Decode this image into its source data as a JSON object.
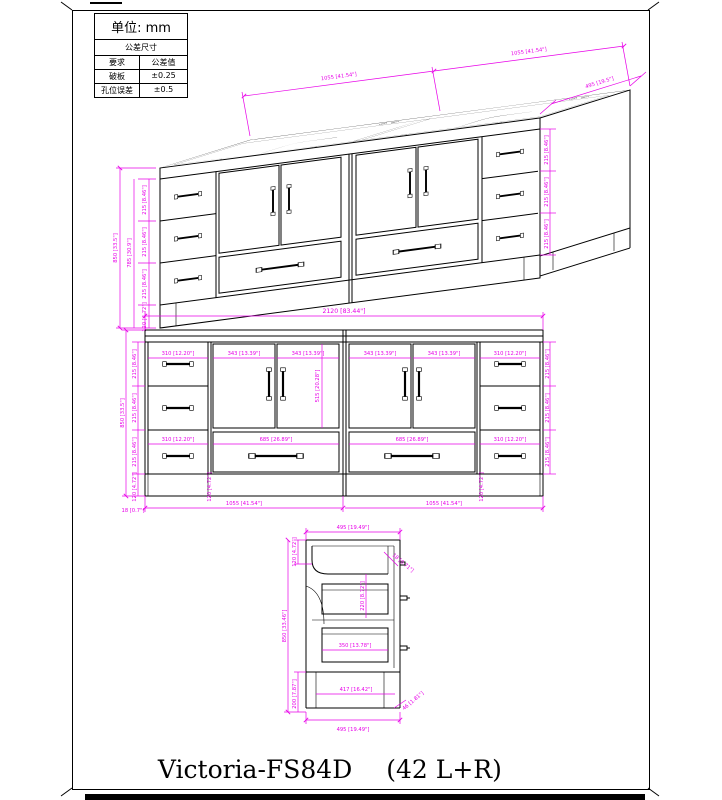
{
  "title": {
    "model": "Victoria-FS84D",
    "config": "(42 L+R)"
  },
  "tolerance_table": {
    "unit_label": "单位: mm",
    "header": "公差尺寸",
    "col_requirement": "要求",
    "col_value": "公差值",
    "rows": [
      {
        "name": "破板",
        "value": "±0.25"
      },
      {
        "name": "孔位误差",
        "value": "±0.5"
      }
    ]
  },
  "colors": {
    "dimension": "#e800e8",
    "line": "#000000"
  },
  "iso_view": {
    "unit_width": "1055 [41.54\"]",
    "depth": "495 [19.5\"]",
    "height": "850 [33.5\"]",
    "drawer_height": "215 [8.46\"]",
    "stack_height": "785 [30.9\"]",
    "toe_height": "120 [4.72\"]"
  },
  "front_view": {
    "total_width": "2120 [83.44\"]",
    "unit_width": "1055 [41.54\"]",
    "drawer_width": "310 [12.20\"]",
    "door_width": "343 [13.39\"]",
    "door_height": "515 [20.28\"]",
    "wide_drawer_width": "685 [26.89\"]",
    "drawer_height": "215 [8.46\"]",
    "height": "850 [33.5\"]",
    "toe_height": "120 [4.72\"]",
    "panel_thickness": "18 [0.7\"]"
  },
  "side_view": {
    "top_width": "495 [19.49\"]",
    "bottom_width": "495 [19.49\"]",
    "height": "850 [33.46\"]",
    "top_inset": "120 [4.72\"]",
    "mid_height": "220 [8.72\"]",
    "panel_thickness": "18 [0.71\"]",
    "drawer_depth": "350 [13.78\"]",
    "toe_depth": "417 [16.42\"]",
    "toe_height": "200 [7.87\"]",
    "rail_height": "46 [1.81\"]"
  }
}
